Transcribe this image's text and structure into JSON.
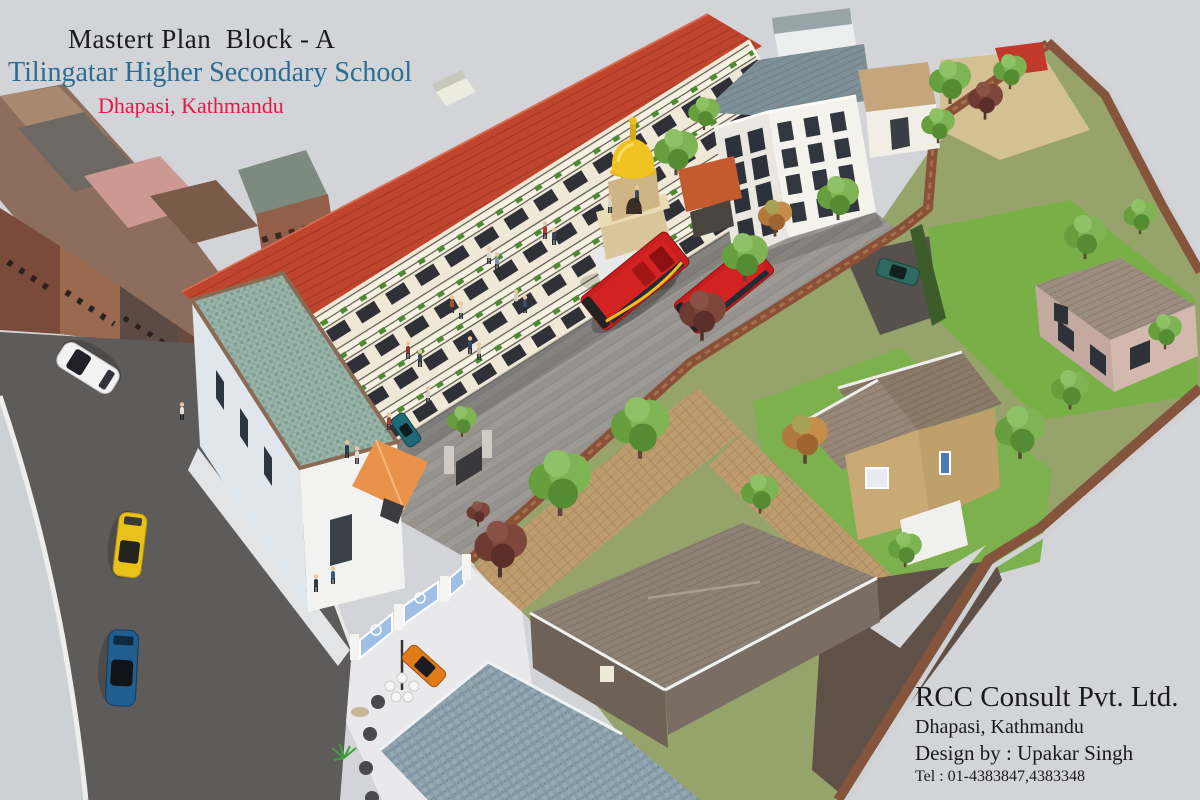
{
  "title_block": {
    "line1": "Mastert Plan  Block - A",
    "line2": "Tilingatar Higher Secondary School",
    "line3": "Dhapasi, Kathmandu"
  },
  "credits_block": {
    "company": "RCC Consult Pvt. Ltd.",
    "location": "Dhapasi, Kathmandu",
    "designer": "Design by : Upakar Singh",
    "phone": "Tel : 01-4383847,4383348"
  },
  "colors": {
    "background": "#d2d4d7",
    "title_primary": "#1b1b1b",
    "title_school": "#2c6d92",
    "title_location": "#e8164b",
    "credits_text": "#1a1a1a",
    "school_roof_red": "#c0452e",
    "school_wall_cream": "#f1ebdb",
    "courtyard_gray": "#9a9792",
    "bus_red": "#c81e1e",
    "lawn_green": "#7ab04a",
    "brick_wall": "#8a5340",
    "road_asphalt": "#5e5b5b",
    "slate_roof": "#7e9097",
    "shingle_roof": "#8d8175",
    "blue_tile_roof": "#8ba2ae"
  }
}
